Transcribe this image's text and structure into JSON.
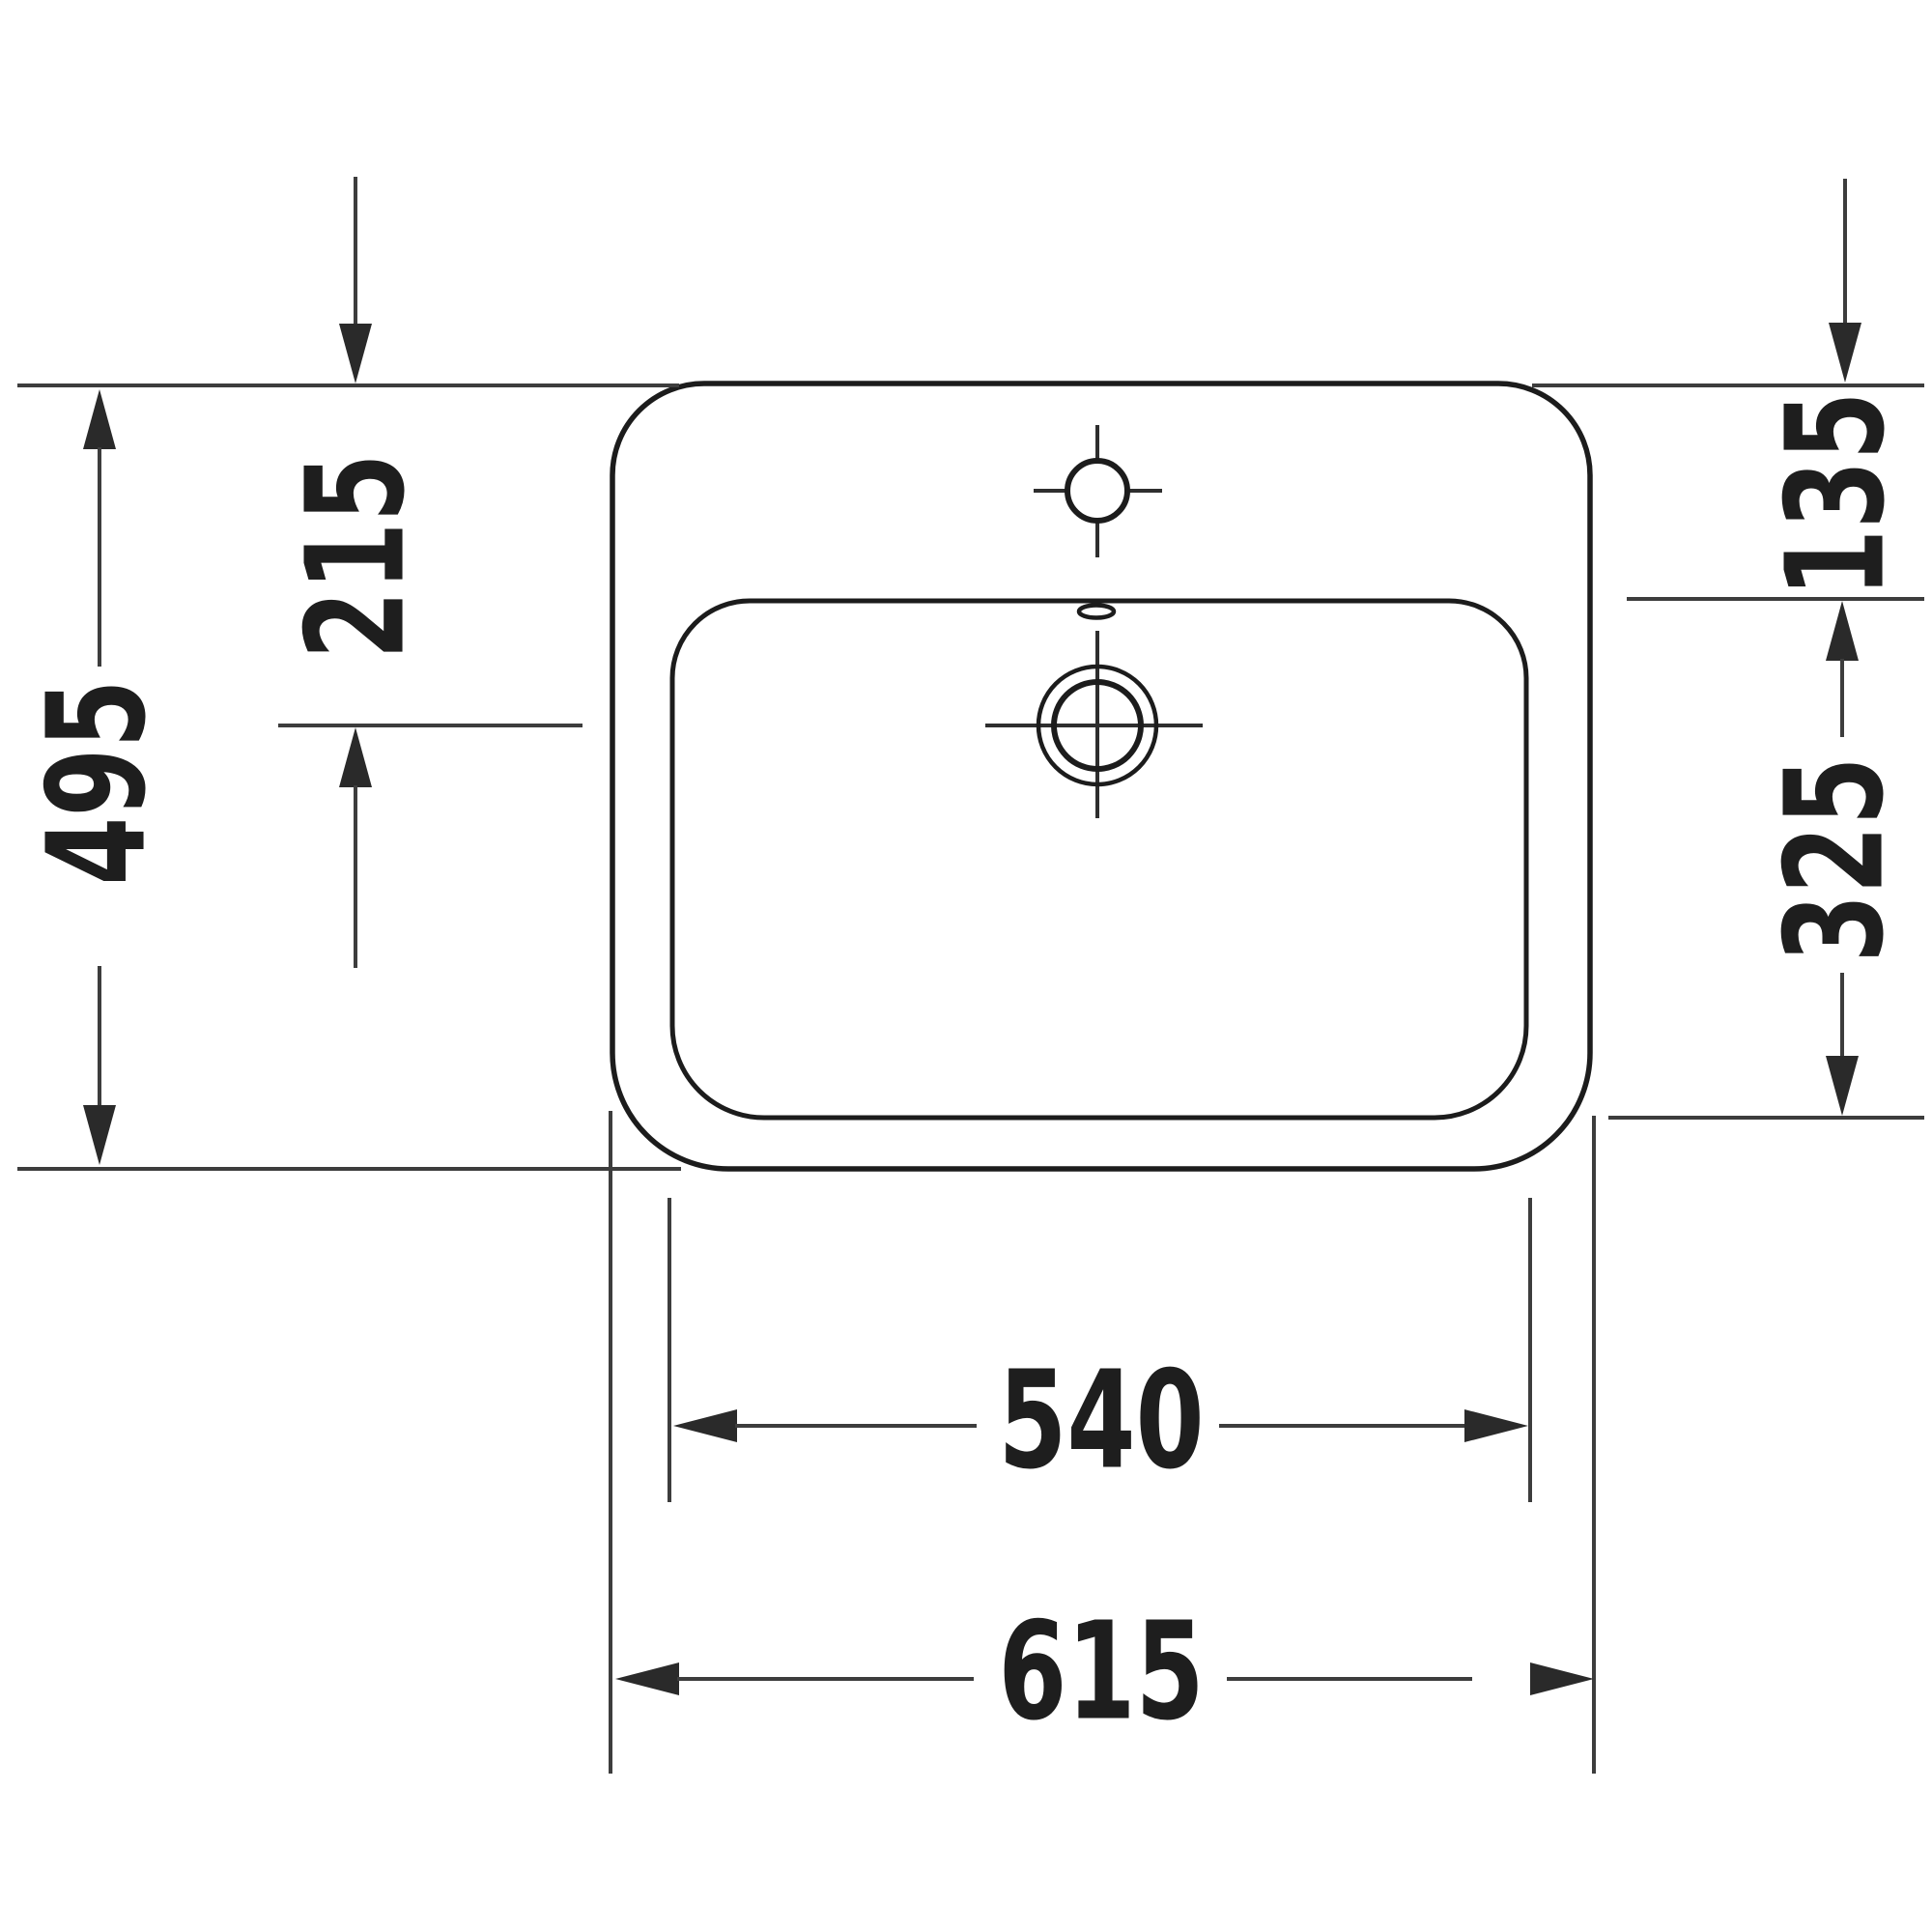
{
  "drawing": {
    "type": "technical-dimension-drawing",
    "subject": "washbasin-top-view",
    "background_color": "#ffffff",
    "outline_color": "#1c1c1c",
    "dimension_line_color": "#3d3d3d",
    "text_color": "#1e1e1e",
    "dimensions": {
      "outer_height": "495",
      "top_edge_to_drain_center": "215",
      "top_edge_to_bowl_front": "135",
      "bowl_inner_depth": "325",
      "bowl_inner_width": "540",
      "outer_width": "615"
    }
  }
}
